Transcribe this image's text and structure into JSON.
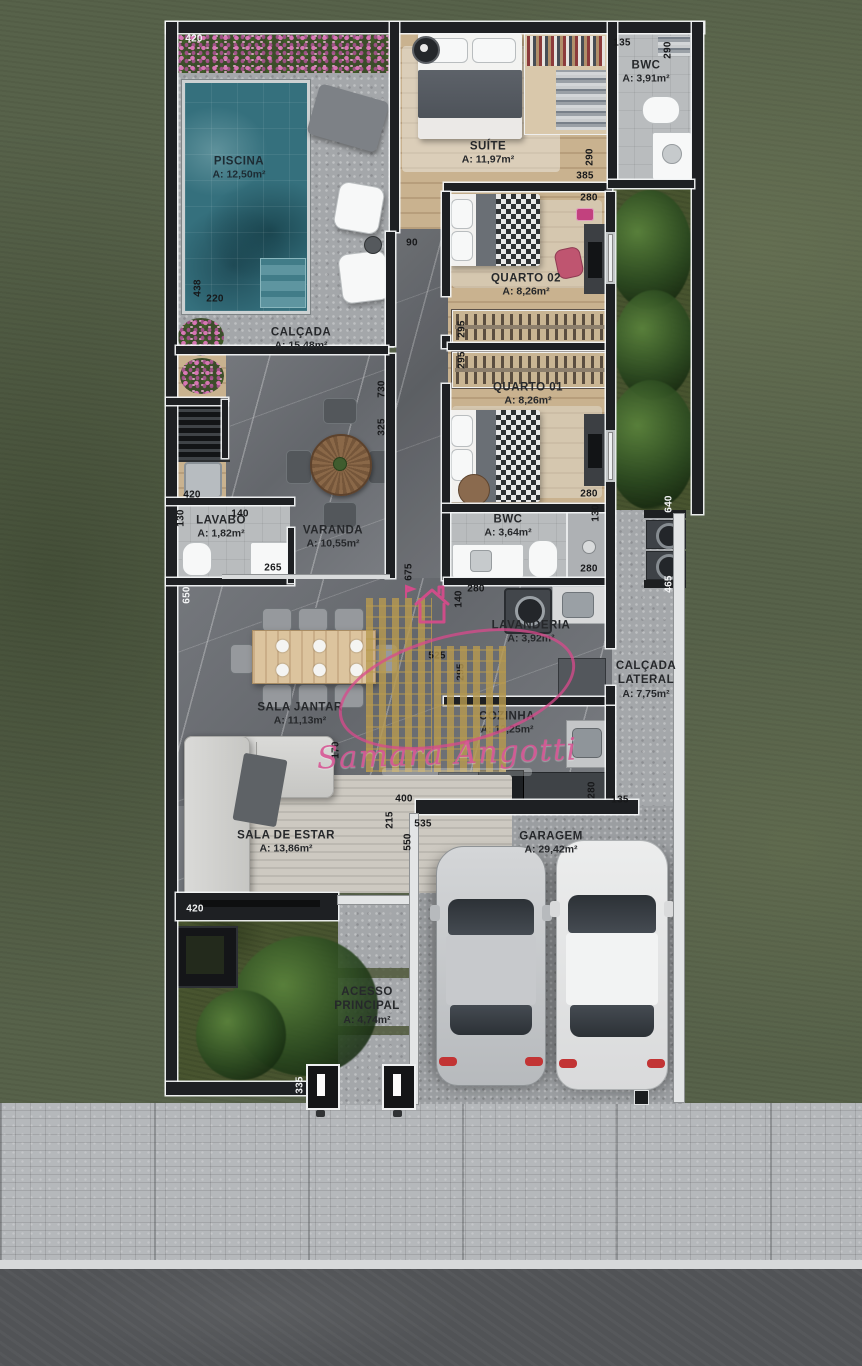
{
  "watermark": {
    "name": "Samara Angotti"
  },
  "palette": {
    "grass": "#57624A",
    "concrete": "#A4A7AA",
    "marble": "#6C6F74",
    "wood": "#CBB492",
    "pool": "#35707D",
    "wall": "#1E2023",
    "flower_pink": "#DE78BA",
    "watermark_pink": "#D65292",
    "watermark_gold": "#B89A4F",
    "taillight_red": "#C23434"
  },
  "rooms": {
    "piscina": {
      "name": "PISCINA",
      "area": "A: 12,50m²"
    },
    "suite": {
      "name": "SUÍTE",
      "area": "A: 11,97m²"
    },
    "bwc_suite": {
      "name": "BWC",
      "area": "A: 3,91m²"
    },
    "quarto02": {
      "name": "QUARTO 02",
      "area": "A: 8,26m²"
    },
    "quarto01": {
      "name": "QUARTO 01",
      "area": "A: 8,26m²"
    },
    "calcada": {
      "name": "CALÇADA",
      "area": "A: 15,48m²"
    },
    "lavabo": {
      "name": "LAVABO",
      "area": "A: 1,82m²"
    },
    "varanda": {
      "name": "VARANDA",
      "area": "A: 10,55m²"
    },
    "bwc": {
      "name": "BWC",
      "area": "A: 3,64m²"
    },
    "lavanderia": {
      "name": "LAVANDERIA",
      "area": "A: 3,92m²"
    },
    "calcada_lateral": {
      "line1": "CALÇADA",
      "line2": "LATERAL",
      "area": "A: 7,75m²"
    },
    "sala_jantar": {
      "name": "SALA JANTAR",
      "area": "A: 11,13m²"
    },
    "cozinha": {
      "name": "COZINHA",
      "area": "A: 12,25m²"
    },
    "sala_estar": {
      "name": "SALA DE ESTAR",
      "area": "A: 13,86m²"
    },
    "garagem": {
      "name": "GARAGEM",
      "area": "A: 29,42m²"
    },
    "acesso": {
      "line1": "ACESSO",
      "line2": "PRINCIPAL",
      "area": "A: 4,74m²"
    }
  },
  "dims": {
    "d420_top": "420",
    "d135_bwc": "135",
    "d290_bwc_r": "290",
    "d290_suite": "290",
    "d385_suite": "385",
    "d280_q2": "280",
    "d90_hall": "90",
    "d295_q2": "295",
    "d295_q1": "295",
    "d438_pool": "438",
    "d220_pool": "220",
    "d730_wall": "730",
    "d325_wall": "325",
    "d420_counter": "420",
    "d130_lavabo": "130",
    "d140_lavabo": "140",
    "d265_lavabo": "265",
    "d675_hall": "675",
    "d650_sala": "650",
    "d280_lavanderia": "280",
    "d140_lavanderia": "140",
    "d295_cozinha": "295",
    "d525_cozinha": "525",
    "d640_lateral": "640",
    "d465_lateral": "465",
    "d130_bwc": "130",
    "d280_bwc": "280",
    "d280_quarto1": "280",
    "d170_estar": "170",
    "d400_estar": "400",
    "d215_garagem": "215",
    "d535_garagem": "535",
    "d550_garagem": "550",
    "d280_cozinha_b": "280",
    "d135_cozinha_b": "135",
    "d420_tv": "420",
    "d335_portao": "335"
  }
}
